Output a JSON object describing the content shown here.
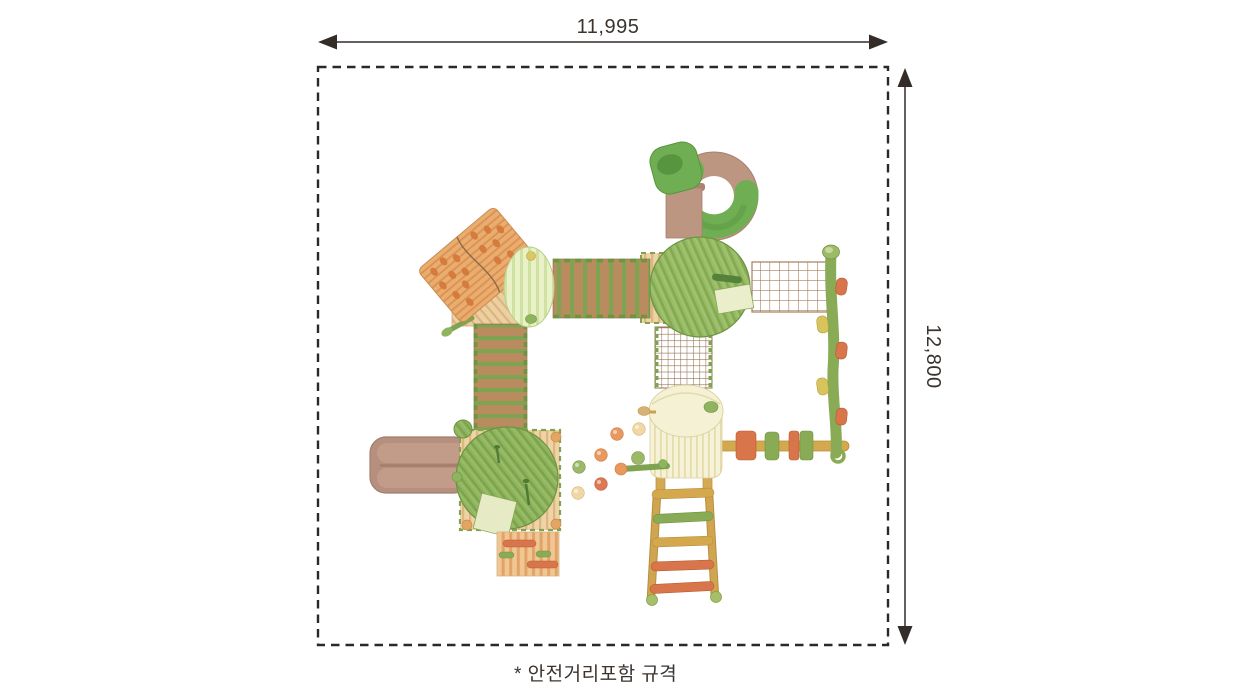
{
  "labels": {
    "width": "11,995",
    "height": "12,800",
    "caption": "* 안전거리포함 규격"
  },
  "diagram": {
    "type": "playground-equipment-top-view-spec",
    "boundary_style": "dashed-safety-boundary",
    "line_color": "#332c28",
    "background": "#ffffff",
    "palette": {
      "wood_tan": "#eed3a6",
      "wood_stripe": "#ddb682",
      "leaf_green": "#90b560",
      "leaf_stripe": "#7da44b",
      "bridge_brown": "#b98b5e",
      "bridge_green": "#7fa351",
      "roof_orange": "#eaad70",
      "roof_dot_orange": "#d67b3e",
      "tube_green": "#6fae53",
      "tube_brown": "#bd9682",
      "net_brown": "#a57f5c",
      "cream": "#f6f2d8",
      "ladder_yellow": "#d4a94e",
      "grip_orange": "#d8754a",
      "grip_yellow": "#d9c35c",
      "ball_orange": "#e9995e",
      "ball_cream": "#f1d7a3",
      "ball_green": "#9cb96a",
      "slide_brown": "#b6907e"
    },
    "parts": [
      {
        "name": "spiral-tube-slide",
        "colors": [
          "#6fae53",
          "#bd9682"
        ]
      },
      {
        "name": "climbing-roof-panel",
        "colors": [
          "#eaad70",
          "#d67b3e"
        ]
      },
      {
        "name": "round-platform-small",
        "colors": [
          "#e9f1c8"
        ]
      },
      {
        "name": "plank-bridge-horizontal",
        "colors": [
          "#b98b5e",
          "#7fa351"
        ]
      },
      {
        "name": "leaf-canopy-top",
        "colors": [
          "#98bb66"
        ]
      },
      {
        "name": "rope-net-horizontal",
        "colors": [
          "#a57f5c"
        ]
      },
      {
        "name": "climbing-pole-with-steps",
        "colors": [
          "#8aab55",
          "#d8754a",
          "#d9c35c"
        ]
      },
      {
        "name": "rope-net-vertical",
        "colors": [
          "#93714f"
        ]
      },
      {
        "name": "plank-bridge-vertical",
        "colors": [
          "#b98b5e",
          "#7fa351"
        ]
      },
      {
        "name": "double-slide",
        "colors": [
          "#b6907e"
        ]
      },
      {
        "name": "square-deck-with-corner-posts",
        "colors": [
          "#eed3a6"
        ]
      },
      {
        "name": "leaf-canopy-bottom",
        "colors": [
          "#90b560"
        ]
      },
      {
        "name": "climbing-ramp-with-grips",
        "colors": [
          "#f0c692",
          "#e2a368"
        ]
      },
      {
        "name": "round-hut-platform",
        "colors": [
          "#f6f2d8"
        ]
      },
      {
        "name": "rope-ladder",
        "colors": [
          "#cfa64f",
          "#8aab55",
          "#d8754a"
        ]
      },
      {
        "name": "overhead-beam-with-grips",
        "colors": [
          "#d4a94e"
        ]
      },
      {
        "name": "scattered-play-balls",
        "colors": [
          "#e9995e",
          "#f1d7a3",
          "#9cb96a",
          "#dd7a55"
        ]
      }
    ]
  }
}
